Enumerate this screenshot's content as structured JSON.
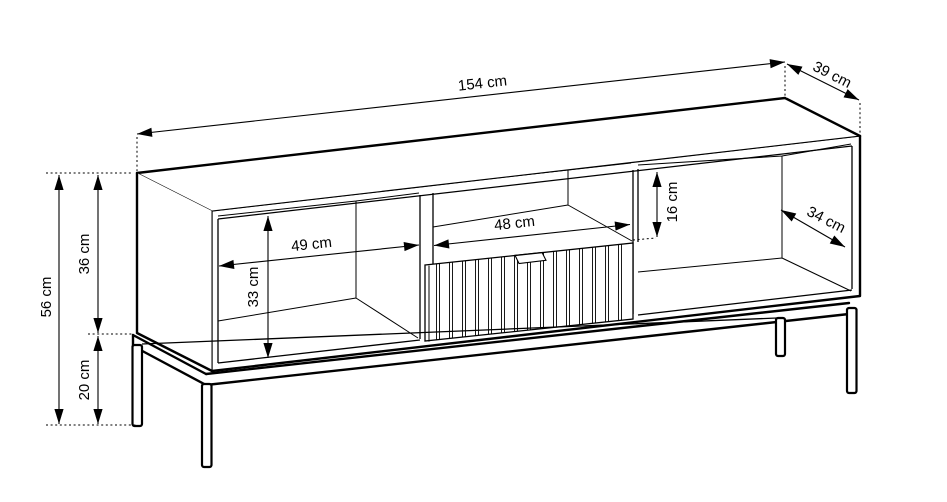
{
  "diagram": {
    "type": "furniture-technical-drawing",
    "line_color": "#000000",
    "background_color": "#ffffff",
    "dimensions": {
      "width": "154 cm",
      "depth": "39 cm",
      "height_total": "56 cm",
      "height_body": "36 cm",
      "height_legs": "20 cm",
      "left_compartment_width": "49 cm",
      "left_compartment_height": "33 cm",
      "niche_width": "48 cm",
      "niche_height": "16 cm",
      "right_compartment_depth": "34 cm"
    }
  }
}
